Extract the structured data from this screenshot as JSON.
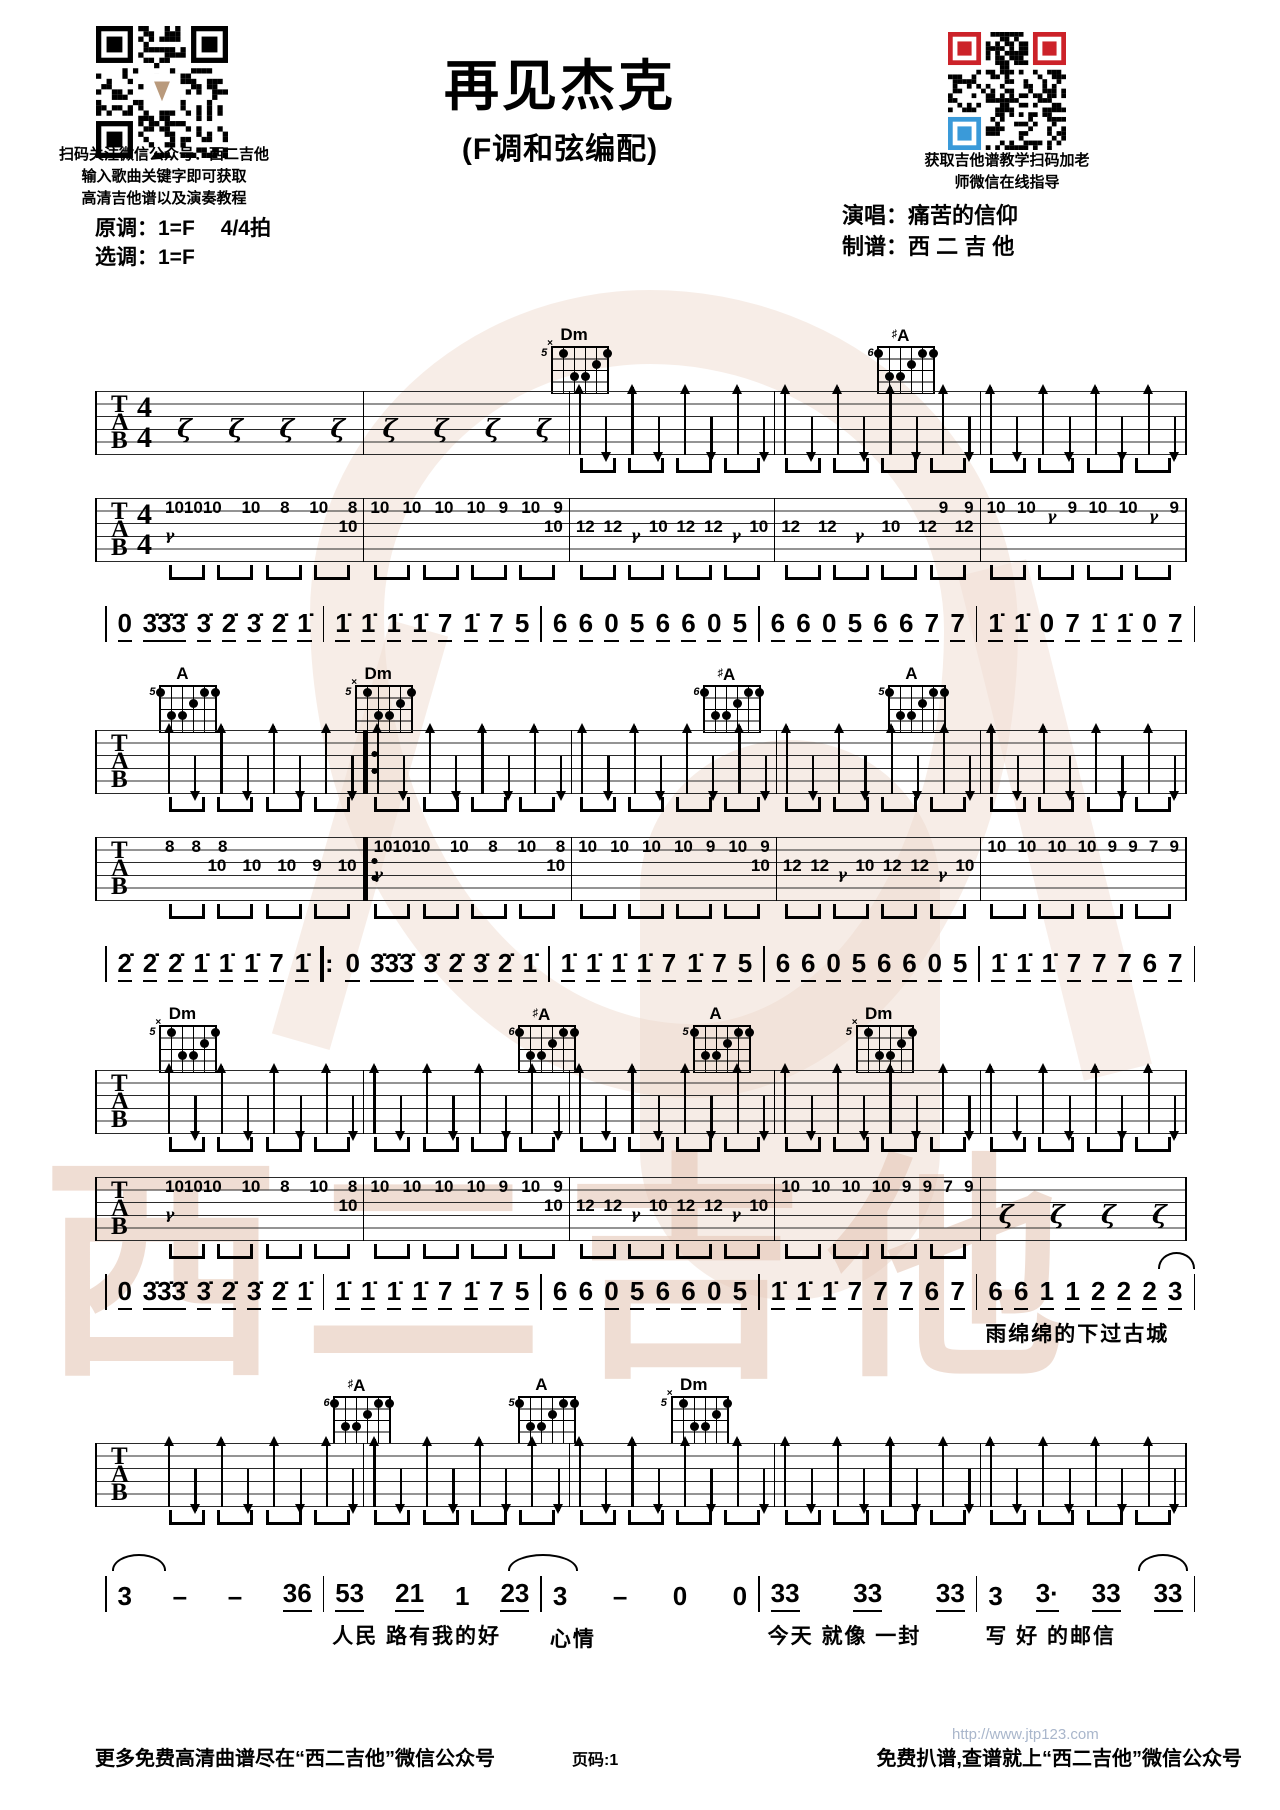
{
  "header": {
    "qr_left_caption": [
      "扫码关注微信公众号：西二吉他",
      "输入歌曲关键字即可获取",
      "高清吉他谱以及演奏教程"
    ],
    "key_original": "原调：1=F",
    "time_sig_text": "4/4拍",
    "key_selected": "选调：1=F",
    "title": "再见杰克",
    "subtitle": "(F调和弦编配)",
    "qr_right_caption": [
      "获取吉他谱教学扫码加老",
      "师微信在线指导"
    ],
    "performer": "演唱：痛苦的信仰",
    "arranger": "制谱：西 二 吉 他"
  },
  "watermark": {
    "text": "西二吉他",
    "color": "#e6c9b9"
  },
  "colors": {
    "qr_red": "#cc2229",
    "qr_blue": "#3a9ad9",
    "ink": "#000000"
  },
  "chord_shapes": {
    "M": {
      "x": false,
      "dots": [
        [
          6,
          1
        ],
        [
          2,
          1
        ],
        [
          1,
          1
        ],
        [
          3,
          2
        ],
        [
          5,
          3
        ],
        [
          4,
          3
        ]
      ]
    },
    "m": {
      "x": true,
      "dots": [
        [
          5,
          1
        ],
        [
          1,
          1
        ],
        [
          2,
          2
        ],
        [
          4,
          3
        ],
        [
          3,
          3
        ]
      ]
    }
  },
  "systems": [
    {
      "chords": [
        {
          "name": "Dm",
          "sharp": false,
          "fret": "5",
          "shape": "m",
          "left_pct": 41
        },
        {
          "name": "A",
          "sharp": true,
          "fret": "6",
          "shape": "M",
          "left_pct": 71
        }
      ],
      "strum_staff": {
        "time_sig": true,
        "repeat_after": null,
        "measures": [
          "rest",
          "rest",
          "strum",
          "strum",
          "strum"
        ]
      },
      "tab_staff": {
        "time_sig": true,
        "repeat_after": null,
        "measures": [
          {
            "hi": [
              "101010",
              "10",
              "8",
              "10",
              "8"
            ],
            "lo": [
              "𝄾",
              "10"
            ]
          },
          {
            "hi": [
              "10",
              "10",
              "10",
              "10",
              "9",
              "10",
              "9"
            ],
            "lo": [
              "10"
            ],
            "lo_align": "right"
          },
          {
            "lo": [
              "12",
              "12",
              "𝄾",
              "10",
              "12",
              "12",
              "𝄾",
              "10"
            ]
          },
          {
            "lo": [
              "12",
              "12",
              "𝄾",
              "10",
              "12",
              "12"
            ],
            "hi": [
              "9",
              "9"
            ],
            "hi_align": "right"
          },
          {
            "hi": [
              "10",
              "10",
              "𝄾",
              "9",
              "10",
              "10",
              "𝄾",
              "9"
            ]
          }
        ]
      },
      "jianpu": {
        "underline_all": true,
        "measures": [
          {
            "notes": "0 3̇3̇3̇ 3̇ 2̇ 3̇ 2̇ 1̇"
          },
          {
            "notes": "1̇ 1̇ 1̇ 1̇ 7 1̇ 7 5"
          },
          {
            "notes": "6 6 0 5 6 6 0 5"
          },
          {
            "notes": "6 6 0 5 6 6 7 7"
          },
          {
            "notes": "1̇ 1̇ 0 7 1̇ 1̇ 0 7"
          }
        ]
      }
    },
    {
      "chords": [
        {
          "name": "A",
          "sharp": false,
          "fret": "5",
          "shape": "M",
          "left_pct": 5
        },
        {
          "name": "Dm",
          "sharp": false,
          "fret": "5",
          "shape": "m",
          "left_pct": 23
        },
        {
          "name": "A",
          "sharp": true,
          "fret": "6",
          "shape": "M",
          "left_pct": 55
        },
        {
          "name": "A",
          "sharp": false,
          "fret": "5",
          "shape": "M",
          "left_pct": 72
        }
      ],
      "strum_staff": {
        "time_sig": false,
        "repeat_after": 1,
        "measures": [
          "strum",
          "strum",
          "strum",
          "strum",
          "strum"
        ]
      },
      "tab_staff": {
        "time_sig": false,
        "repeat_after": 1,
        "measures": [
          {
            "hi": [
              "8",
              "8",
              "8"
            ],
            "hi_align": "left",
            "lo": [
              "10",
              "10",
              "10",
              "9",
              "10"
            ],
            "lo_align": "right"
          },
          {
            "hi": [
              "101010",
              "10",
              "8",
              "10",
              "8"
            ],
            "lo": [
              "𝄾",
              "10"
            ]
          },
          {
            "hi": [
              "10",
              "10",
              "10",
              "10",
              "9",
              "10",
              "9"
            ],
            "lo": [
              "10"
            ],
            "lo_align": "right"
          },
          {
            "lo": [
              "12",
              "12",
              "𝄾",
              "10",
              "12",
              "12",
              "𝄾",
              "10"
            ]
          },
          {
            "hi": [
              "10",
              "10",
              "10",
              "10",
              "9",
              "9",
              "7",
              "9"
            ]
          }
        ]
      },
      "jianpu": {
        "underline_all": true,
        "measures": [
          {
            "notes": "2̇ 2̇ 2̇ 1̇ 1̇ 1̇ 7 1̇"
          },
          {
            "notes": "0 3̇3̇3̇ 3̇ 2̇ 3̇ 2̇ 1̇",
            "repeat_before": true
          },
          {
            "notes": "1̇ 1̇ 1̇ 1̇ 7 1̇ 7 5"
          },
          {
            "notes": "6 6 0 5 6 6 0 5"
          },
          {
            "notes": "1̇ 1̇ 1̇ 7 7 7 6 7"
          }
        ]
      }
    },
    {
      "chords": [
        {
          "name": "Dm",
          "sharp": false,
          "fret": "5",
          "shape": "m",
          "left_pct": 5
        },
        {
          "name": "A",
          "sharp": true,
          "fret": "6",
          "shape": "M",
          "left_pct": 38
        },
        {
          "name": "A",
          "sharp": false,
          "fret": "5",
          "shape": "M",
          "left_pct": 54
        },
        {
          "name": "Dm",
          "sharp": false,
          "fret": "5",
          "shape": "m",
          "left_pct": 69
        }
      ],
      "strum_staff": {
        "time_sig": false,
        "repeat_after": null,
        "measures": [
          "strum",
          "strum",
          "strum",
          "strum",
          "strum"
        ]
      },
      "tab_staff": {
        "time_sig": false,
        "repeat_after": null,
        "measures": [
          {
            "hi": [
              "101010",
              "10",
              "8",
              "10",
              "8"
            ],
            "lo": [
              "𝄾",
              "10"
            ]
          },
          {
            "hi": [
              "10",
              "10",
              "10",
              "10",
              "9",
              "10",
              "9"
            ],
            "lo": [
              "10"
            ],
            "lo_align": "right"
          },
          {
            "lo": [
              "12",
              "12",
              "𝄾",
              "10",
              "12",
              "12",
              "𝄾",
              "10"
            ]
          },
          {
            "hi": [
              "10",
              "10",
              "10",
              "10",
              "9",
              "9",
              "7",
              "9"
            ]
          },
          "rest"
        ]
      },
      "jianpu": {
        "underline_all": true,
        "end_arc": true,
        "measures": [
          {
            "notes": "0 3̇3̇3̇ 3̇ 2̇ 3̇ 2̇ 1̇"
          },
          {
            "notes": "1̇ 1̇ 1̇ 1̇ 7 1̇ 7 5"
          },
          {
            "notes": "6 6 0 5 6 6 0 5"
          },
          {
            "notes": "1̇ 1̇ 1̇ 7 7 7 6 7"
          },
          {
            "notes": "6 6 1 1 2 2 2 3",
            "lyric": "雨绵绵的下过古城"
          }
        ]
      }
    },
    {
      "chords": [
        {
          "name": "A",
          "sharp": true,
          "fret": "6",
          "shape": "M",
          "left_pct": 21
        },
        {
          "name": "A",
          "sharp": false,
          "fret": "5",
          "shape": "M",
          "left_pct": 38
        },
        {
          "name": "Dm",
          "sharp": false,
          "fret": "5",
          "shape": "m",
          "left_pct": 52
        }
      ],
      "strum_staff": {
        "time_sig": false,
        "repeat_after": null,
        "measures": [
          "strum",
          "strum",
          "strum",
          "strum",
          "strum"
        ]
      },
      "tab_staff": null,
      "jianpu": {
        "underline_all": false,
        "arcs": true,
        "measures": [
          {
            "notes": "3 – – _36"
          },
          {
            "notes": "_53 _21 1 _23",
            "lyric": "人民 路有我的好"
          },
          {
            "notes": "3 – 0 0",
            "lyric": "心情"
          },
          {
            "notes": "_33 _33 _33",
            "lyric": "今天 就像 一封"
          },
          {
            "notes": "3 _3· _33 _33",
            "lyric": "写 好 的邮信"
          }
        ]
      }
    }
  ],
  "footer": {
    "left": "更多免费高清曲谱尽在“西二吉他”微信公众号",
    "page_label": "页码:1",
    "url": "http://www.jtp123.com",
    "right": "免费扒谱,查谱就上“西二吉他”微信公众号"
  }
}
